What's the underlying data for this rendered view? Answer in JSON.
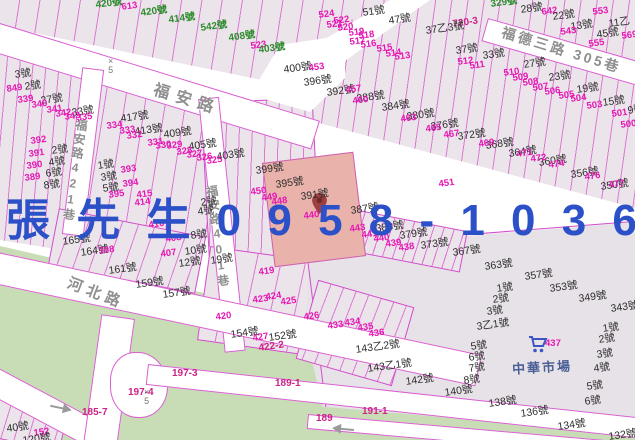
{
  "title_overlay": {
    "text": "張 先 生 0 9 5 8 - 1 0 3 6 8 0",
    "color": "#2b50c8"
  },
  "roads": {
    "fuan": "福安路",
    "fuan_lane421": "福安路421巷",
    "lane401": "福安路401巷",
    "hebei": "河北路",
    "fude3": "福德三路 305巷",
    "market": "中華市場"
  },
  "colors": {
    "parcel": "#ebe4ea",
    "stripe": "#d64ccc",
    "road_edge": "#d95fd0",
    "green_area": "#c8dcb6",
    "market_block": "#e7e2e7",
    "highlight_parcel": "#e9b3ab",
    "advert_blue": "#2b50c8",
    "label_black": "#2c2c2c",
    "label_magenta": "#e518b4",
    "label_green": "#2e8b2e",
    "road_text": "#8f8f8f"
  },
  "markers": [
    {
      "type": "x5",
      "x": 108,
      "y": 57
    },
    {
      "type": "x5",
      "x": 144,
      "y": 388
    }
  ],
  "labels": [
    [
      "420號",
      95,
      1,
      "g"
    ],
    [
      "613",
      121,
      3,
      "m"
    ],
    [
      "420號",
      140,
      9,
      "g"
    ],
    [
      "414號",
      168,
      16,
      "g"
    ],
    [
      "542號",
      200,
      24,
      "g"
    ],
    [
      "408號",
      228,
      34,
      "g"
    ],
    [
      "523",
      250,
      42,
      "m"
    ],
    [
      "403號",
      258,
      46,
      "g"
    ],
    [
      "329號",
      490,
      0,
      "g"
    ],
    [
      "28號",
      520,
      5,
      "k"
    ],
    [
      "642",
      541,
      8,
      "m"
    ],
    [
      "22號",
      552,
      12,
      "k"
    ],
    [
      "553",
      592,
      8,
      "m"
    ],
    [
      "13號",
      570,
      22,
      "k"
    ],
    [
      "11乙",
      608,
      19,
      "k"
    ],
    [
      "543",
      560,
      28,
      "m"
    ],
    [
      "45號",
      596,
      30,
      "k"
    ],
    [
      "555",
      588,
      40,
      "m"
    ],
    [
      "569",
      621,
      32,
      "m"
    ],
    [
      "51號",
      362,
      8,
      "k"
    ],
    [
      "47號",
      388,
      16,
      "k"
    ],
    [
      "720-3",
      452,
      20,
      "rm"
    ],
    [
      "37乙3號",
      425,
      26,
      "k"
    ],
    [
      "37號",
      455,
      46,
      "k"
    ],
    [
      "33號",
      482,
      51,
      "k"
    ],
    [
      "27號",
      523,
      60,
      "k"
    ],
    [
      "23號",
      548,
      73,
      "k"
    ],
    [
      "19號",
      576,
      85,
      "k"
    ],
    [
      "15號",
      602,
      98,
      "k"
    ],
    [
      "9號",
      627,
      106,
      "k"
    ],
    [
      "524",
      318,
      11,
      "m"
    ],
    [
      "522",
      333,
      17,
      "m"
    ],
    [
      "521",
      326,
      21,
      "m"
    ],
    [
      "520",
      337,
      24,
      "m"
    ],
    [
      "519",
      348,
      29,
      "m"
    ],
    [
      "518",
      358,
      32,
      "m"
    ],
    [
      "517",
      349,
      38,
      "m"
    ],
    [
      "516",
      360,
      41,
      "m"
    ],
    [
      "515",
      376,
      45,
      "m"
    ],
    [
      "514",
      385,
      50,
      "m"
    ],
    [
      "513",
      394,
      53,
      "m"
    ],
    [
      "512",
      457,
      58,
      "m"
    ],
    [
      "511",
      469,
      62,
      "m"
    ],
    [
      "510",
      503,
      69,
      "m"
    ],
    [
      "509",
      512,
      74,
      "m"
    ],
    [
      "508",
      522,
      79,
      "m"
    ],
    [
      "507",
      532,
      84,
      "m"
    ],
    [
      "506",
      544,
      88,
      "m"
    ],
    [
      "505",
      558,
      92,
      "m"
    ],
    [
      "504",
      570,
      95,
      "m"
    ],
    [
      "503",
      586,
      102,
      "m"
    ],
    [
      "501",
      611,
      110,
      "m"
    ],
    [
      "500",
      620,
      121,
      "m"
    ],
    [
      "3號",
      14,
      70,
      "k"
    ],
    [
      "849",
      6,
      85,
      "m"
    ],
    [
      "2號",
      24,
      82,
      "k"
    ],
    [
      "339",
      17,
      96,
      "m"
    ],
    [
      "27號",
      40,
      96,
      "k"
    ],
    [
      "340",
      31,
      101,
      "m"
    ],
    [
      "341",
      46,
      106,
      "m"
    ],
    [
      "33號",
      71,
      108,
      "k"
    ],
    [
      "342",
      55,
      110,
      "m"
    ],
    [
      "343",
      64,
      113,
      "m"
    ],
    [
      "335",
      76,
      114,
      "m"
    ],
    [
      "417號",
      120,
      114,
      "k"
    ],
    [
      "334",
      106,
      122,
      "m"
    ],
    [
      "333",
      119,
      127,
      "m"
    ],
    [
      "413號",
      134,
      127,
      "k"
    ],
    [
      "332",
      126,
      132,
      "m"
    ],
    [
      "331",
      147,
      139,
      "m"
    ],
    [
      "409號",
      163,
      130,
      "k"
    ],
    [
      "330",
      155,
      142,
      "m"
    ],
    [
      "329",
      166,
      142,
      "m"
    ],
    [
      "405號",
      188,
      142,
      "k"
    ],
    [
      "328",
      176,
      148,
      "m"
    ],
    [
      "327",
      186,
      151,
      "m"
    ],
    [
      "403號",
      216,
      152,
      "k"
    ],
    [
      "326",
      196,
      154,
      "m"
    ],
    [
      "325",
      206,
      157,
      "m"
    ],
    [
      "399號",
      255,
      166,
      "k"
    ],
    [
      "395號",
      275,
      180,
      "k"
    ],
    [
      "392",
      30,
      137,
      "m"
    ],
    [
      "2號",
      51,
      146,
      "k"
    ],
    [
      "391",
      28,
      150,
      "m"
    ],
    [
      "4號",
      48,
      158,
      "k"
    ],
    [
      "390",
      26,
      162,
      "m"
    ],
    [
      "6號",
      45,
      169,
      "k"
    ],
    [
      "389",
      24,
      174,
      "m"
    ],
    [
      "8號",
      43,
      181,
      "k"
    ],
    [
      "1號",
      97,
      161,
      "k"
    ],
    [
      "393",
      120,
      166,
      "m"
    ],
    [
      "3號",
      100,
      173,
      "k"
    ],
    [
      "394",
      122,
      180,
      "m"
    ],
    [
      "5號",
      102,
      184,
      "k"
    ],
    [
      "395",
      108,
      191,
      "m"
    ],
    [
      "415",
      136,
      191,
      "m"
    ],
    [
      "2號",
      200,
      198,
      "k"
    ],
    [
      "414",
      134,
      199,
      "m"
    ],
    [
      "4號",
      197,
      207,
      "k"
    ],
    [
      "410",
      148,
      221,
      "m"
    ],
    [
      "408",
      165,
      235,
      "m"
    ],
    [
      "407",
      160,
      250,
      "m"
    ],
    [
      "8號",
      190,
      231,
      "k"
    ],
    [
      "10號",
      184,
      247,
      "k"
    ],
    [
      "12號",
      178,
      259,
      "k"
    ],
    [
      "19號",
      210,
      256,
      "k"
    ],
    [
      "400號",
      283,
      65,
      "k"
    ],
    [
      "453",
      308,
      64,
      "m"
    ],
    [
      "396號",
      303,
      78,
      "k"
    ],
    [
      "450",
      250,
      188,
      "m"
    ],
    [
      "449",
      261,
      194,
      "m"
    ],
    [
      "448",
      271,
      198,
      "m"
    ],
    [
      "391號",
      300,
      192,
      "k"
    ],
    [
      "440",
      303,
      212,
      "m"
    ],
    [
      "387號",
      350,
      206,
      "k"
    ],
    [
      "451",
      438,
      180,
      "m"
    ],
    [
      "443",
      349,
      225,
      "m"
    ],
    [
      "441",
      361,
      231,
      "m"
    ],
    [
      "440",
      373,
      235,
      "m"
    ],
    [
      "439",
      385,
      240,
      "m"
    ],
    [
      "438",
      398,
      244,
      "m"
    ],
    [
      "383號",
      375,
      224,
      "k"
    ],
    [
      "379號",
      399,
      231,
      "k"
    ],
    [
      "373號",
      420,
      241,
      "k"
    ],
    [
      "367號",
      452,
      248,
      "k"
    ],
    [
      "363號",
      484,
      262,
      "k"
    ],
    [
      "357號",
      524,
      272,
      "k"
    ],
    [
      "353號",
      549,
      284,
      "k"
    ],
    [
      "349號",
      578,
      294,
      "k"
    ],
    [
      "343號",
      610,
      304,
      "k"
    ],
    [
      "1號",
      496,
      284,
      "k"
    ],
    [
      "2號",
      492,
      295,
      "k"
    ],
    [
      "3號",
      486,
      307,
      "k"
    ],
    [
      "3乙1號",
      476,
      322,
      "k"
    ],
    [
      "5號",
      470,
      342,
      "k"
    ],
    [
      "6號",
      468,
      353,
      "k"
    ],
    [
      "7號",
      468,
      364,
      "k"
    ],
    [
      "8號",
      463,
      376,
      "k"
    ],
    [
      "142號",
      405,
      377,
      "k"
    ],
    [
      "140號",
      444,
      388,
      "k"
    ],
    [
      "138號",
      488,
      399,
      "k"
    ],
    [
      "136號",
      520,
      409,
      "k"
    ],
    [
      "134號",
      557,
      422,
      "k"
    ],
    [
      "132號",
      608,
      432,
      "k"
    ],
    [
      "143乙2號",
      355,
      345,
      "k"
    ],
    [
      "143乙1號",
      367,
      364,
      "k"
    ],
    [
      "1號",
      602,
      324,
      "k"
    ],
    [
      "2號",
      598,
      335,
      "k"
    ],
    [
      "3號",
      596,
      350,
      "k"
    ],
    [
      "4號",
      593,
      364,
      "k"
    ],
    [
      "5號",
      586,
      382,
      "k"
    ],
    [
      "6號",
      584,
      397,
      "k"
    ],
    [
      "433",
      327,
      322,
      "m"
    ],
    [
      "434",
      344,
      319,
      "m"
    ],
    [
      "435",
      357,
      324,
      "m"
    ],
    [
      "436",
      368,
      330,
      "m"
    ],
    [
      "392號",
      326,
      88,
      "k"
    ],
    [
      "457",
      345,
      86,
      "m"
    ],
    [
      "388號",
      356,
      94,
      "k"
    ],
    [
      "384號",
      381,
      103,
      "k"
    ],
    [
      "380號",
      406,
      112,
      "k"
    ],
    [
      "376號",
      430,
      122,
      "k"
    ],
    [
      "372號",
      457,
      132,
      "k"
    ],
    [
      "368號",
      485,
      141,
      "k"
    ],
    [
      "364號",
      508,
      149,
      "k"
    ],
    [
      "360號",
      538,
      158,
      "k"
    ],
    [
      "356號",
      570,
      170,
      "k"
    ],
    [
      "350號",
      600,
      182,
      "k"
    ],
    [
      "460",
      352,
      97,
      "m"
    ],
    [
      "463",
      400,
      115,
      "m"
    ],
    [
      "465",
      425,
      125,
      "m"
    ],
    [
      "467",
      443,
      131,
      "m"
    ],
    [
      "469",
      478,
      140,
      "m"
    ],
    [
      "471",
      516,
      150,
      "m"
    ],
    [
      "472",
      530,
      155,
      "m"
    ],
    [
      "474",
      548,
      161,
      "m"
    ],
    [
      "476",
      584,
      173,
      "m"
    ],
    [
      "477",
      608,
      181,
      "m"
    ],
    [
      "165號",
      62,
      237,
      "k"
    ],
    [
      "164號",
      80,
      248,
      "k"
    ],
    [
      "398",
      98,
      247,
      "m"
    ],
    [
      "161號",
      108,
      266,
      "k"
    ],
    [
      "159號",
      135,
      280,
      "k"
    ],
    [
      "157號",
      162,
      290,
      "k"
    ],
    [
      "419",
      258,
      268,
      "m"
    ],
    [
      "423",
      252,
      296,
      "m"
    ],
    [
      "424",
      265,
      293,
      "m"
    ],
    [
      "425",
      280,
      298,
      "m"
    ],
    [
      "426",
      303,
      313,
      "m"
    ],
    [
      "420",
      215,
      313,
      "m"
    ],
    [
      "154號",
      230,
      330,
      "k"
    ],
    [
      "152號",
      268,
      333,
      "k"
    ],
    [
      "427",
      252,
      334,
      "m"
    ],
    [
      "422-2",
      258,
      344,
      "rm"
    ],
    [
      "197-3",
      172,
      369,
      "rm",
      0
    ],
    [
      "189-1",
      275,
      379,
      "rm",
      0
    ],
    [
      "197-4",
      128,
      388,
      "rm",
      0
    ],
    [
      "185-7",
      82,
      408,
      "rm",
      0
    ],
    [
      "191-1",
      362,
      407,
      "rm",
      0
    ],
    [
      "189",
      316,
      414,
      "rm",
      0
    ],
    [
      "40號",
      6,
      424,
      "k"
    ],
    [
      "152",
      33,
      429,
      "m"
    ],
    [
      "120號",
      22,
      436,
      "k"
    ],
    [
      "437",
      545,
      339,
      "m",
      0
    ]
  ]
}
